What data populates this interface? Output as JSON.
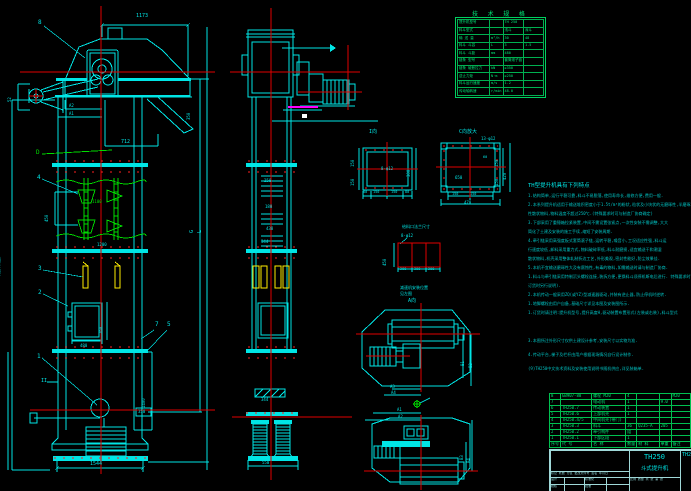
{
  "colors": {
    "background": "#000000",
    "cyan": "#00e5e5",
    "green": "#00dd00",
    "red": "#ff2020",
    "yellow": "#ffee00",
    "magenta": "#ff00ff",
    "white": "#ffffff",
    "table_green": "#00e878"
  },
  "spec_table": {
    "title": "技 术 规 格",
    "col_widths": [
      32,
      13,
      20,
      20
    ],
    "rows": [
      [
        "提升机型号",
        "",
        "TH 250",
        ""
      ],
      [
        "料斗型式",
        "",
        "浅斗",
        "深斗"
      ],
      [
        "输 送 量",
        "m³/h",
        "30",
        "48"
      ],
      [
        "料斗 斗容",
        "L",
        "3",
        "1.5"
      ],
      [
        "料斗 斗距",
        "mm",
        "480",
        ""
      ],
      [
        "链条 型号",
        "",
        "套筒滚子链",
        ""
      ],
      [
        "链条 破断拉力",
        "kN",
        "≥350",
        ""
      ],
      [
        "逆止力矩",
        "N·m",
        "≥250",
        ""
      ],
      [
        "料斗运行速度",
        "m/s",
        "1.2",
        ""
      ],
      [
        "传动轴转速",
        "r/min",
        "48.0",
        ""
      ]
    ]
  },
  "notes": {
    "title": "TH型提升机具有下列特点",
    "lines": [
      "1.结构简单,运行平稳可靠,料斗不易脱落,使用寿命长,维修方便,费用一般.",
      "2.本系列提升机适用于输送堆积密度小于1.5t/m³的粉状,粒状及小块状的无磨琢性,半磨琢",
      "  性散状物料,物料温度不超过250℃.(特殊要求时可与制造厂协商确定)",
      "3.下部采用了重锤箱拉紧装置,中间不需设置张紧点,一次性安装不需调整,大大",
      "  简化了土建及安装的施工手续,缩短了安装周期.",
      "4.牵引链采用高强度板式套筒滚子链,运转平稳,噪音小,工况适应性强,料斗运",
      "  行速度较低,卸料采用重力式,物料破碎率低,料斗耐磨损,适宜输送干和潮湿",
      "  散状物料,机壳采用整体轧制折边工艺,外形美观,密封性能好,防尘效果佳.",
      "5.本机不宜输送磨琢性大及有腐蚀性,有毒的物料,如需输送时请与制造厂协商.",
      "1.料斗与牵引链采用特制沉头螺栓连接,装拆方便,更换料斗须停机断电后进行.          特殊要求时可与制造厂协商(确定",
      "  订货时另行说明).",
      "2.本机传动一般采用ZQ(或YZ)型减速器驱动,并装有逆止器,防止停机时逆转.",
      "1.地脚螺栓由用户自备,基础尺寸详见本图及安装图所示.",
      "1.订货时请注明:提升机型号,提升高度H,驱动装置布置形式(左装或右装),料斗型式"
    ]
  },
  "notes_extra": {
    "lines": [
      "3.本图所注外形尺寸仅供土建设计参考,安装尺寸以实物为准.",
      "4.传动平台,梯子及栏杆由用户根据现场情况自行设计制作.",
      "(9)TH250中文技术资料及安装使用说明书随机供应,详见装箱单."
    ]
  },
  "parts_list": {
    "col_widths": [
      9,
      37,
      36,
      11,
      27,
      13,
      27
    ],
    "rows": [
      [
        "8",
        "GB907-88",
        "螺栓  M20",
        "4",
        "",
        "",
        "M20"
      ],
      [
        "7",
        "",
        "电动机",
        "1",
        "",
        "9.0",
        ""
      ],
      [
        "6",
        "TH250.7",
        "传动装置",
        "1",
        "",
        "",
        ""
      ],
      [
        "5",
        "TH250.6",
        "上部机壳",
        "1",
        "",
        "",
        ""
      ],
      [
        "4",
        "TH250.4/5",
        "中间机壳(带门)",
        "",
        "",
        "",
        ""
      ],
      [
        "3",
        "TH250.3",
        "料斗",
        "36",
        "Q235-A",
        "205",
        ""
      ],
      [
        "2",
        "TH250.2",
        "牵引构件",
        "组",
        "",
        "",
        ""
      ],
      [
        "1",
        "TH250.1",
        "下部区段",
        "1",
        "",
        "",
        ""
      ],
      [
        "序号",
        "代  号",
        "名  称",
        "数量",
        "材  料",
        "单重",
        "备注"
      ]
    ]
  },
  "title_block": {
    "model": "TH250",
    "product": "斗式提升机",
    "drawing_no": "TH250",
    "rev_row": "标记 处数 分区 更改文件号 签名 年月日",
    "sig": [
      "设计",
      "校核",
      "审核",
      "标准化",
      "批准"
    ],
    "sheet_row": "比例  质量  共 张 第 张"
  },
  "labels": [
    {
      "t": "1173",
      "x": 136,
      "y": 14,
      "c": "cy",
      "s": 5
    },
    {
      "t": "8",
      "x": 38,
      "y": 20,
      "c": "cy",
      "s": 6
    },
    {
      "t": "52",
      "x": 12,
      "y": 98,
      "c": "cy",
      "s": 4,
      "r": -90
    },
    {
      "t": "A2",
      "x": 69,
      "y": 104,
      "c": "cy",
      "s": 4
    },
    {
      "t": "A1",
      "x": 69,
      "y": 112,
      "c": "cy",
      "s": 4
    },
    {
      "t": "712",
      "x": 121,
      "y": 140,
      "c": "cy",
      "s": 5
    },
    {
      "t": "350",
      "x": 191,
      "y": 116,
      "c": "cy",
      "s": 4,
      "r": -90
    },
    {
      "t": "D",
      "x": 36,
      "y": 150,
      "c": "gr",
      "s": 6
    },
    {
      "t": "4",
      "x": 37,
      "y": 175,
      "c": "cy",
      "s": 6
    },
    {
      "t": "450",
      "x": 49,
      "y": 218,
      "c": "cy",
      "s": 4,
      "r": -90
    },
    {
      "t": "1100",
      "x": 92,
      "y": 200,
      "c": "gr",
      "s": 4
    },
    {
      "t": "1200",
      "x": 97,
      "y": 243,
      "c": "cy",
      "s": 4
    },
    {
      "t": "3",
      "x": 38,
      "y": 266,
      "c": "cy",
      "s": 6
    },
    {
      "t": "2",
      "x": 38,
      "y": 290,
      "c": "cy",
      "s": 6
    },
    {
      "t": "760",
      "x": 103,
      "y": 330,
      "c": "cy",
      "s": 4,
      "r": -90
    },
    {
      "t": "480",
      "x": 80,
      "y": 344,
      "c": "cy",
      "s": 4
    },
    {
      "t": "7",
      "x": 155,
      "y": 322,
      "c": "cy",
      "s": 6
    },
    {
      "t": "5",
      "x": 167,
      "y": 322,
      "c": "cy",
      "s": 6
    },
    {
      "t": "1",
      "x": 37,
      "y": 354,
      "c": "cy",
      "s": 6
    },
    {
      "t": "II",
      "x": 41,
      "y": 379,
      "c": "cy",
      "s": 5
    },
    {
      "t": "H(提升高度)",
      "x": 1,
      "y": 275,
      "c": "cy",
      "s": 4,
      "r": -90
    },
    {
      "t": "1333",
      "x": 1,
      "y": 420,
      "c": "cy",
      "s": 4,
      "r": -90
    },
    {
      "t": "1400",
      "x": 146,
      "y": 404,
      "c": "cy",
      "s": 4,
      "r": -90
    },
    {
      "t": "350",
      "x": 138,
      "y": 410,
      "c": "cy",
      "s": 4
    },
    {
      "t": "1544",
      "x": 90,
      "y": 462,
      "c": "cy",
      "s": 5
    },
    {
      "t": "G",
      "x": 195,
      "y": 228,
      "c": "cy",
      "s": 5,
      "r": -90
    },
    {
      "t": "L",
      "x": 203,
      "y": 228,
      "c": "cy",
      "s": 5,
      "r": -90
    },
    {
      "t": "250",
      "x": 264,
      "y": 179,
      "c": "cy",
      "s": 4
    },
    {
      "t": "180",
      "x": 265,
      "y": 205,
      "c": "cy",
      "s": 4
    },
    {
      "t": "438",
      "x": 266,
      "y": 227,
      "c": "cy",
      "s": 4
    },
    {
      "t": "344",
      "x": 261,
      "y": 240,
      "c": "cy",
      "s": 4
    },
    {
      "t": "344",
      "x": 261,
      "y": 398,
      "c": "cy",
      "s": 4
    },
    {
      "t": "550",
      "x": 262,
      "y": 461,
      "c": "cy",
      "s": 4
    },
    {
      "t": "I向",
      "x": 369,
      "y": 130,
      "c": "cy",
      "s": 5
    },
    {
      "t": "8-φ12",
      "x": 381,
      "y": 167,
      "c": "cy",
      "s": 4
    },
    {
      "t": "150",
      "x": 355,
      "y": 163,
      "c": "cy",
      "s": 4,
      "r": -90
    },
    {
      "t": "150",
      "x": 355,
      "y": 182,
      "c": "cy",
      "s": 4,
      "r": -90
    },
    {
      "t": "300",
      "x": 411,
      "y": 173,
      "c": "cy",
      "s": 4,
      "r": -90
    },
    {
      "t": "80",
      "x": 363,
      "y": 191,
      "c": "cy",
      "s": 3.5
    },
    {
      "t": "150",
      "x": 373,
      "y": 191,
      "c": "cy",
      "s": 3.5
    },
    {
      "t": "150",
      "x": 391,
      "y": 191,
      "c": "cy",
      "s": 3.5
    },
    {
      "t": "80",
      "x": 405,
      "y": 191,
      "c": "cy",
      "s": 3.5
    },
    {
      "t": "C向放大",
      "x": 459,
      "y": 130,
      "c": "cy",
      "s": 5
    },
    {
      "t": "13-φ12",
      "x": 481,
      "y": 137,
      "c": "cy",
      "s": 4
    },
    {
      "t": "650",
      "x": 455,
      "y": 176,
      "c": "cy",
      "s": 4
    },
    {
      "t": "60",
      "x": 483,
      "y": 156,
      "c": "cy",
      "s": 3.5
    },
    {
      "t": "150",
      "x": 499,
      "y": 163,
      "c": "cy",
      "s": 4,
      "r": -90
    },
    {
      "t": "150",
      "x": 499,
      "y": 182,
      "c": "cy",
      "s": 4,
      "r": -90
    },
    {
      "t": "420",
      "x": 507,
      "y": 176,
      "c": "cy",
      "s": 4,
      "r": -90
    },
    {
      "t": "150",
      "x": 452,
      "y": 193,
      "c": "cy",
      "s": 3.5
    },
    {
      "t": "150",
      "x": 470,
      "y": 193,
      "c": "cy",
      "s": 3.5
    },
    {
      "t": "470",
      "x": 464,
      "y": 201,
      "c": "cy",
      "s": 4
    },
    {
      "t": "给料口法兰尺寸",
      "x": 402,
      "y": 225,
      "c": "cy",
      "s": 4
    },
    {
      "t": "8-φ12",
      "x": 401,
      "y": 234,
      "c": "cy",
      "s": 4
    },
    {
      "t": "450",
      "x": 387,
      "y": 262,
      "c": "cy",
      "s": 4,
      "r": -90
    },
    {
      "t": "200",
      "x": 400,
      "y": 268,
      "c": "cy",
      "s": 3.5
    },
    {
      "t": "300",
      "x": 414,
      "y": 268,
      "c": "cy",
      "s": 3.5
    },
    {
      "t": "200",
      "x": 428,
      "y": 268,
      "c": "cy",
      "s": 3.5
    },
    {
      "t": "减速机安装位置",
      "x": 400,
      "y": 286,
      "c": "cy",
      "s": 4
    },
    {
      "t": "见左图",
      "x": 400,
      "y": 292,
      "c": "cy",
      "s": 4
    },
    {
      "t": "A向",
      "x": 408,
      "y": 299,
      "c": "cy",
      "s": 5
    },
    {
      "t": "B1",
      "x": 465,
      "y": 362,
      "c": "cy",
      "s": 4,
      "r": -90
    },
    {
      "t": "B2",
      "x": 473,
      "y": 364,
      "c": "cy",
      "s": 4,
      "r": -90
    },
    {
      "t": "A3",
      "x": 390,
      "y": 385,
      "c": "cy",
      "s": 4
    },
    {
      "t": "A4",
      "x": 391,
      "y": 391,
      "c": "cy",
      "s": 4
    },
    {
      "t": "A1",
      "x": 397,
      "y": 408,
      "c": "cy",
      "s": 4
    },
    {
      "t": "A2",
      "x": 398,
      "y": 415,
      "c": "cy",
      "s": 4
    },
    {
      "t": "B3",
      "x": 464,
      "y": 456,
      "c": "cy",
      "s": 4,
      "r": -90
    },
    {
      "t": "B4",
      "x": 471,
      "y": 459,
      "c": "cy",
      "s": 4,
      "r": -90
    }
  ]
}
